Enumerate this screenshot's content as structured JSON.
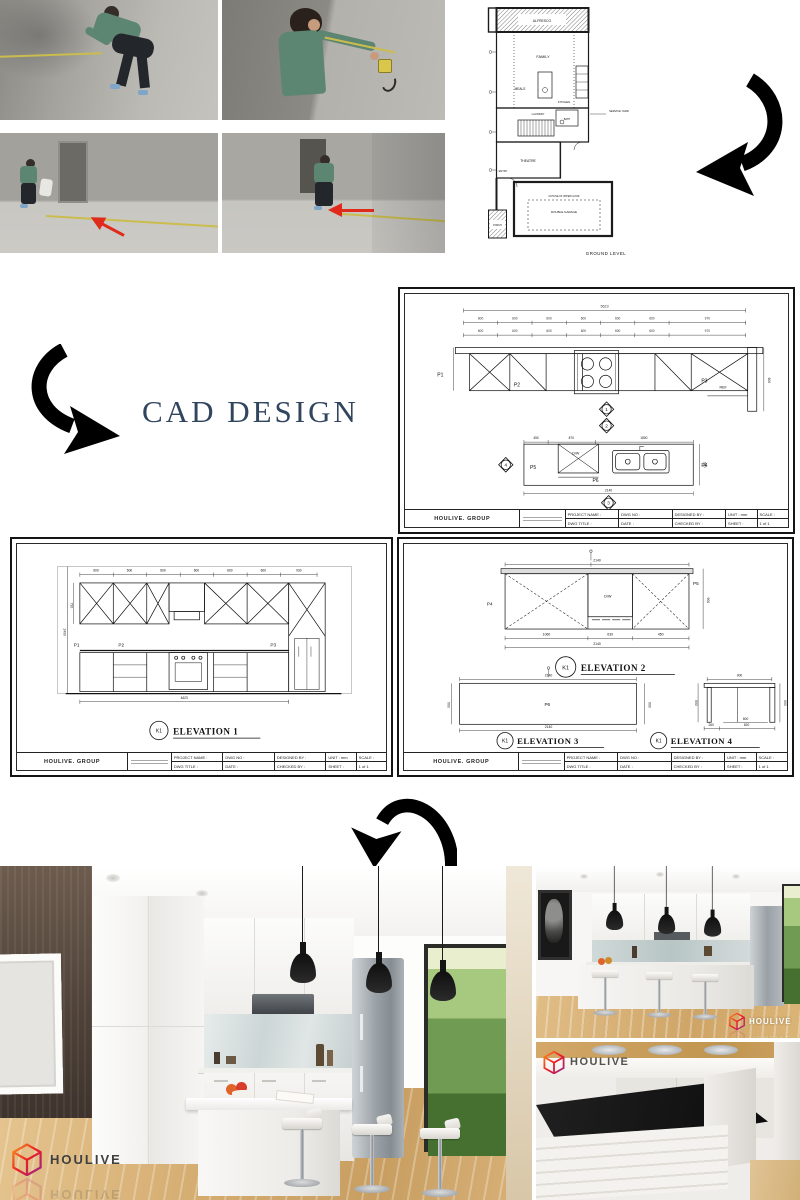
{
  "cad_heading": {
    "label": "CAD DESIGN"
  },
  "watermark": {
    "brand": "HOULIVE"
  },
  "floor_plan": {
    "caption": "GROUND LEVEL",
    "rooms": {
      "alfresco": "ALFRESCO",
      "family": "FAMILY",
      "meals": "MEALS",
      "kitchen": "KITCHEN",
      "laundry": "LAUNDRY",
      "bath": "BATH",
      "service_yard": "SERVICE YARD",
      "theatre": "THEATRE",
      "entry": "ENTRY",
      "porch": "PORCH",
      "garage": "DOUBLE GARAGE",
      "upper_note": "OUTLINE OF UPPER FLOOR"
    }
  },
  "title_block": {
    "company": "HOULIVE. GROUP",
    "project_name": "PROJECT NAME :",
    "dwg_title": "DWG TITLE :",
    "dwg_no": "DWG NO :",
    "date": "DATE :",
    "designed_by": "DESIGNED BY :",
    "checked_by": "CHECKED BY :",
    "unit": "UNIT : mm",
    "scale": "SCALE :",
    "sheet": "SHEET :",
    "sheet_no": "1 of 1"
  },
  "plan_sheet": {
    "dims_top": [
      "600",
      "600",
      "600",
      "600",
      "600",
      "600",
      "970"
    ],
    "total_top": "5623",
    "side_dim": "600",
    "island_dims": [
      "450",
      "870",
      "1800"
    ],
    "island_total": "2140",
    "island_height": "900",
    "labels": {
      "p1": "P1",
      "p2": "P2",
      "p3": "P3",
      "p4": "P4",
      "p5": "P5",
      "p6": "P6",
      "ref": "REF",
      "dw": "D/W"
    },
    "markers": [
      "1",
      "2",
      "3",
      "4"
    ]
  },
  "elevation1": {
    "marker": "K1",
    "title": "ELEVATION 1",
    "dims_top": [
      "600",
      "600",
      "600",
      "600",
      "600",
      "600",
      "930"
    ],
    "total_bottom": "4623",
    "height_left": "2400",
    "height_upper": "730",
    "labels": {
      "p1": "P1",
      "p2": "P2",
      "p3": "P3"
    }
  },
  "elevation2": {
    "marker": "K1",
    "title": "ELEVATION 2",
    "dim_top": "2140",
    "height_right": "900",
    "dims_bottom": [
      "1060",
      "630",
      "450"
    ],
    "total_bottom": "2140",
    "labels": {
      "p4": "P4",
      "p5": "P5",
      "dw": "D/W"
    }
  },
  "elevation3": {
    "marker": "K1",
    "title": "ELEVATION 3",
    "dim_top": "2140",
    "dim_bottom": "2140",
    "height": "900",
    "label": "P6"
  },
  "elevation4": {
    "marker": "K1",
    "title": "ELEVATION 4",
    "dim_top": "900",
    "height": "900",
    "dims_bottom": [
      "260",
      "620"
    ],
    "inner_dim": "600"
  }
}
